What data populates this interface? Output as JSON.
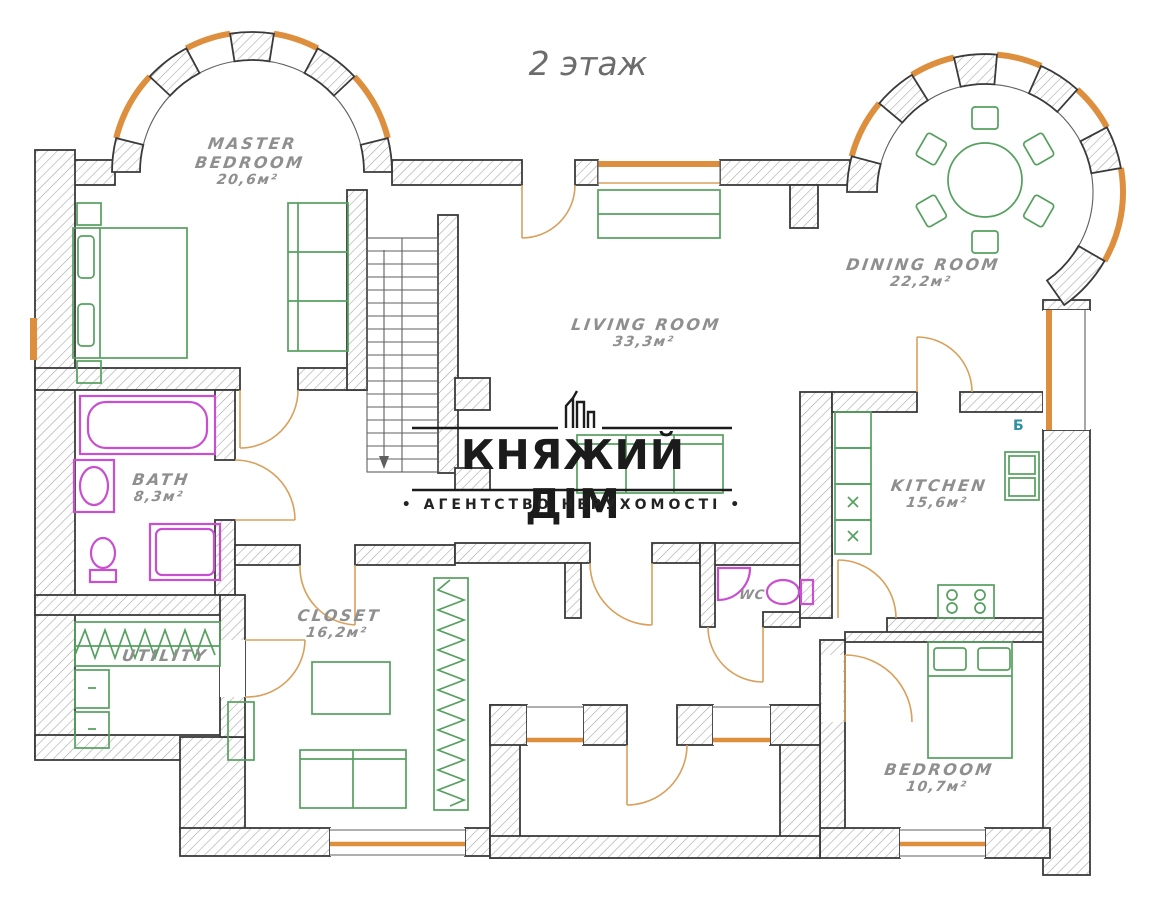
{
  "title": "2 этаж",
  "watermark": {
    "brand": "КНЯЖИЙ ДІМ",
    "tagline": "• АГЕНТСТВО НЕРУХОМОСТІ •"
  },
  "rooms": {
    "master_bedroom": {
      "line1": "MASTER",
      "line2": "BEDROOM",
      "area": "20,6м²"
    },
    "living_room": {
      "name": "LIVING ROOM",
      "area": "33,3м²"
    },
    "dining_room": {
      "name": "DINING ROOM",
      "area": "22,2м²"
    },
    "kitchen": {
      "name": "KITCHEN",
      "area": "15,6м²",
      "boiler_symbol": "Б"
    },
    "bath": {
      "name": "BATH",
      "area": "8,3м²"
    },
    "closet": {
      "name": "CLOSET",
      "area": "16,2м²"
    },
    "utility": {
      "name": "UTILITY"
    },
    "wc": {
      "name": "WC"
    },
    "bedroom": {
      "name": "BEDROOM",
      "area": "10,7м²"
    }
  },
  "colors": {
    "wall_outline": "#3a3a3a",
    "hatch_line": "#a8a8a8",
    "window_accent": "#dd8f3d",
    "door_arc": "#d9a05b",
    "furniture_green": "#55a05f",
    "sanitary_magenta": "#c84fd0",
    "label_gray": "#8f8f8f",
    "watermark_black": "#1b1b1b"
  }
}
